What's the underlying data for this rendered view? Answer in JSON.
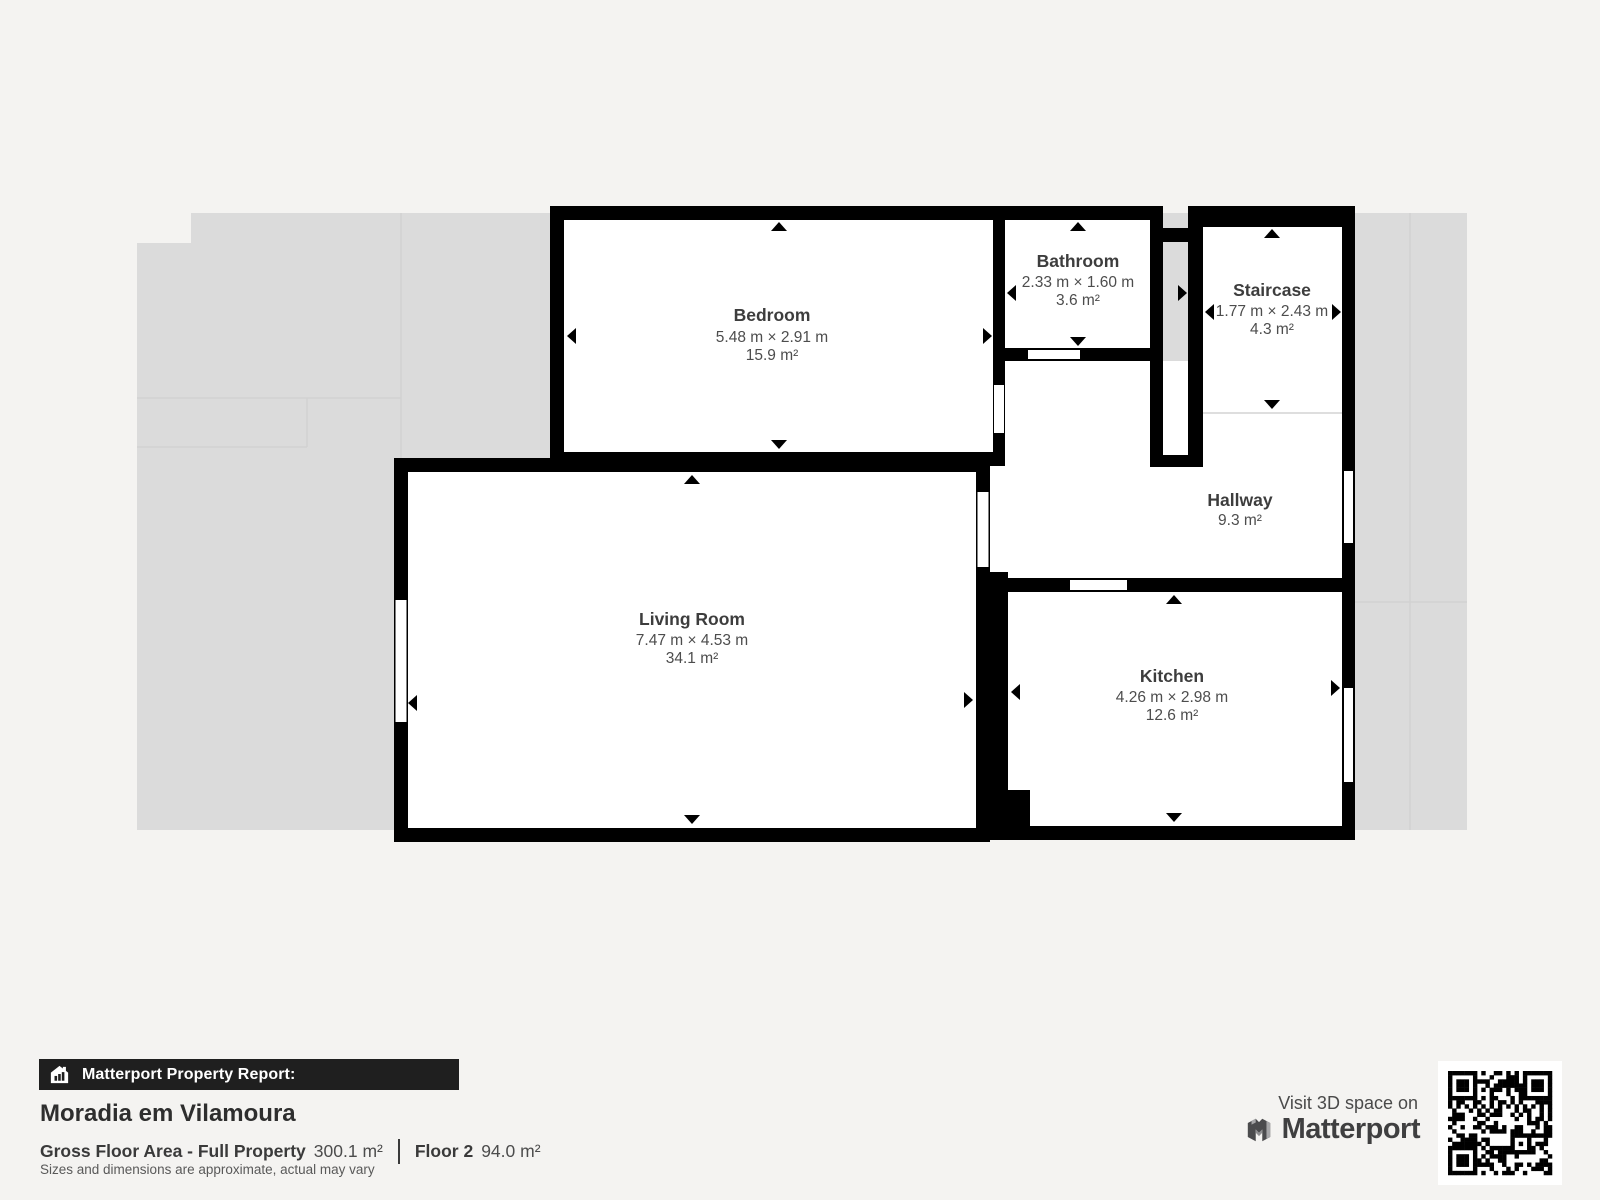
{
  "report": {
    "badge_label": "Matterport Property Report:",
    "property_name": "Moradia em Vilamoura",
    "gross_area_label": "Gross Floor Area - Full Property",
    "gross_area_value": "300.1 m²",
    "floor_label": "Floor 2",
    "floor_area_value": "94.0 m²",
    "disclaimer": "Sizes and dimensions are approximate, actual may vary"
  },
  "cta": {
    "visit_label": "Visit 3D space on",
    "brand_name": "Matterport"
  },
  "floor_plan": {
    "rooms": [
      {
        "name": "Bedroom",
        "dims": "5.48 m × 2.91 m",
        "area": "15.9 m²"
      },
      {
        "name": "Bathroom",
        "dims": "2.33 m × 1.60 m",
        "area": "3.6 m²"
      },
      {
        "name": "Staircase",
        "dims": "1.77 m × 2.43 m",
        "area": "4.3 m²"
      },
      {
        "name": "Hallway",
        "dims": "",
        "area": "9.3 m²"
      },
      {
        "name": "Living Room",
        "dims": "7.47 m × 4.53 m",
        "area": "34.1 m²"
      },
      {
        "name": "Kitchen",
        "dims": "4.26 m × 2.98 m",
        "area": "12.6 m²"
      }
    ]
  },
  "colors": {
    "background": "#f4f3f1",
    "wall": "#000000",
    "adjacent_floor": "#dbdbdb",
    "badge_bar": "#1f1f1f",
    "room_floor": "#ffffff"
  }
}
